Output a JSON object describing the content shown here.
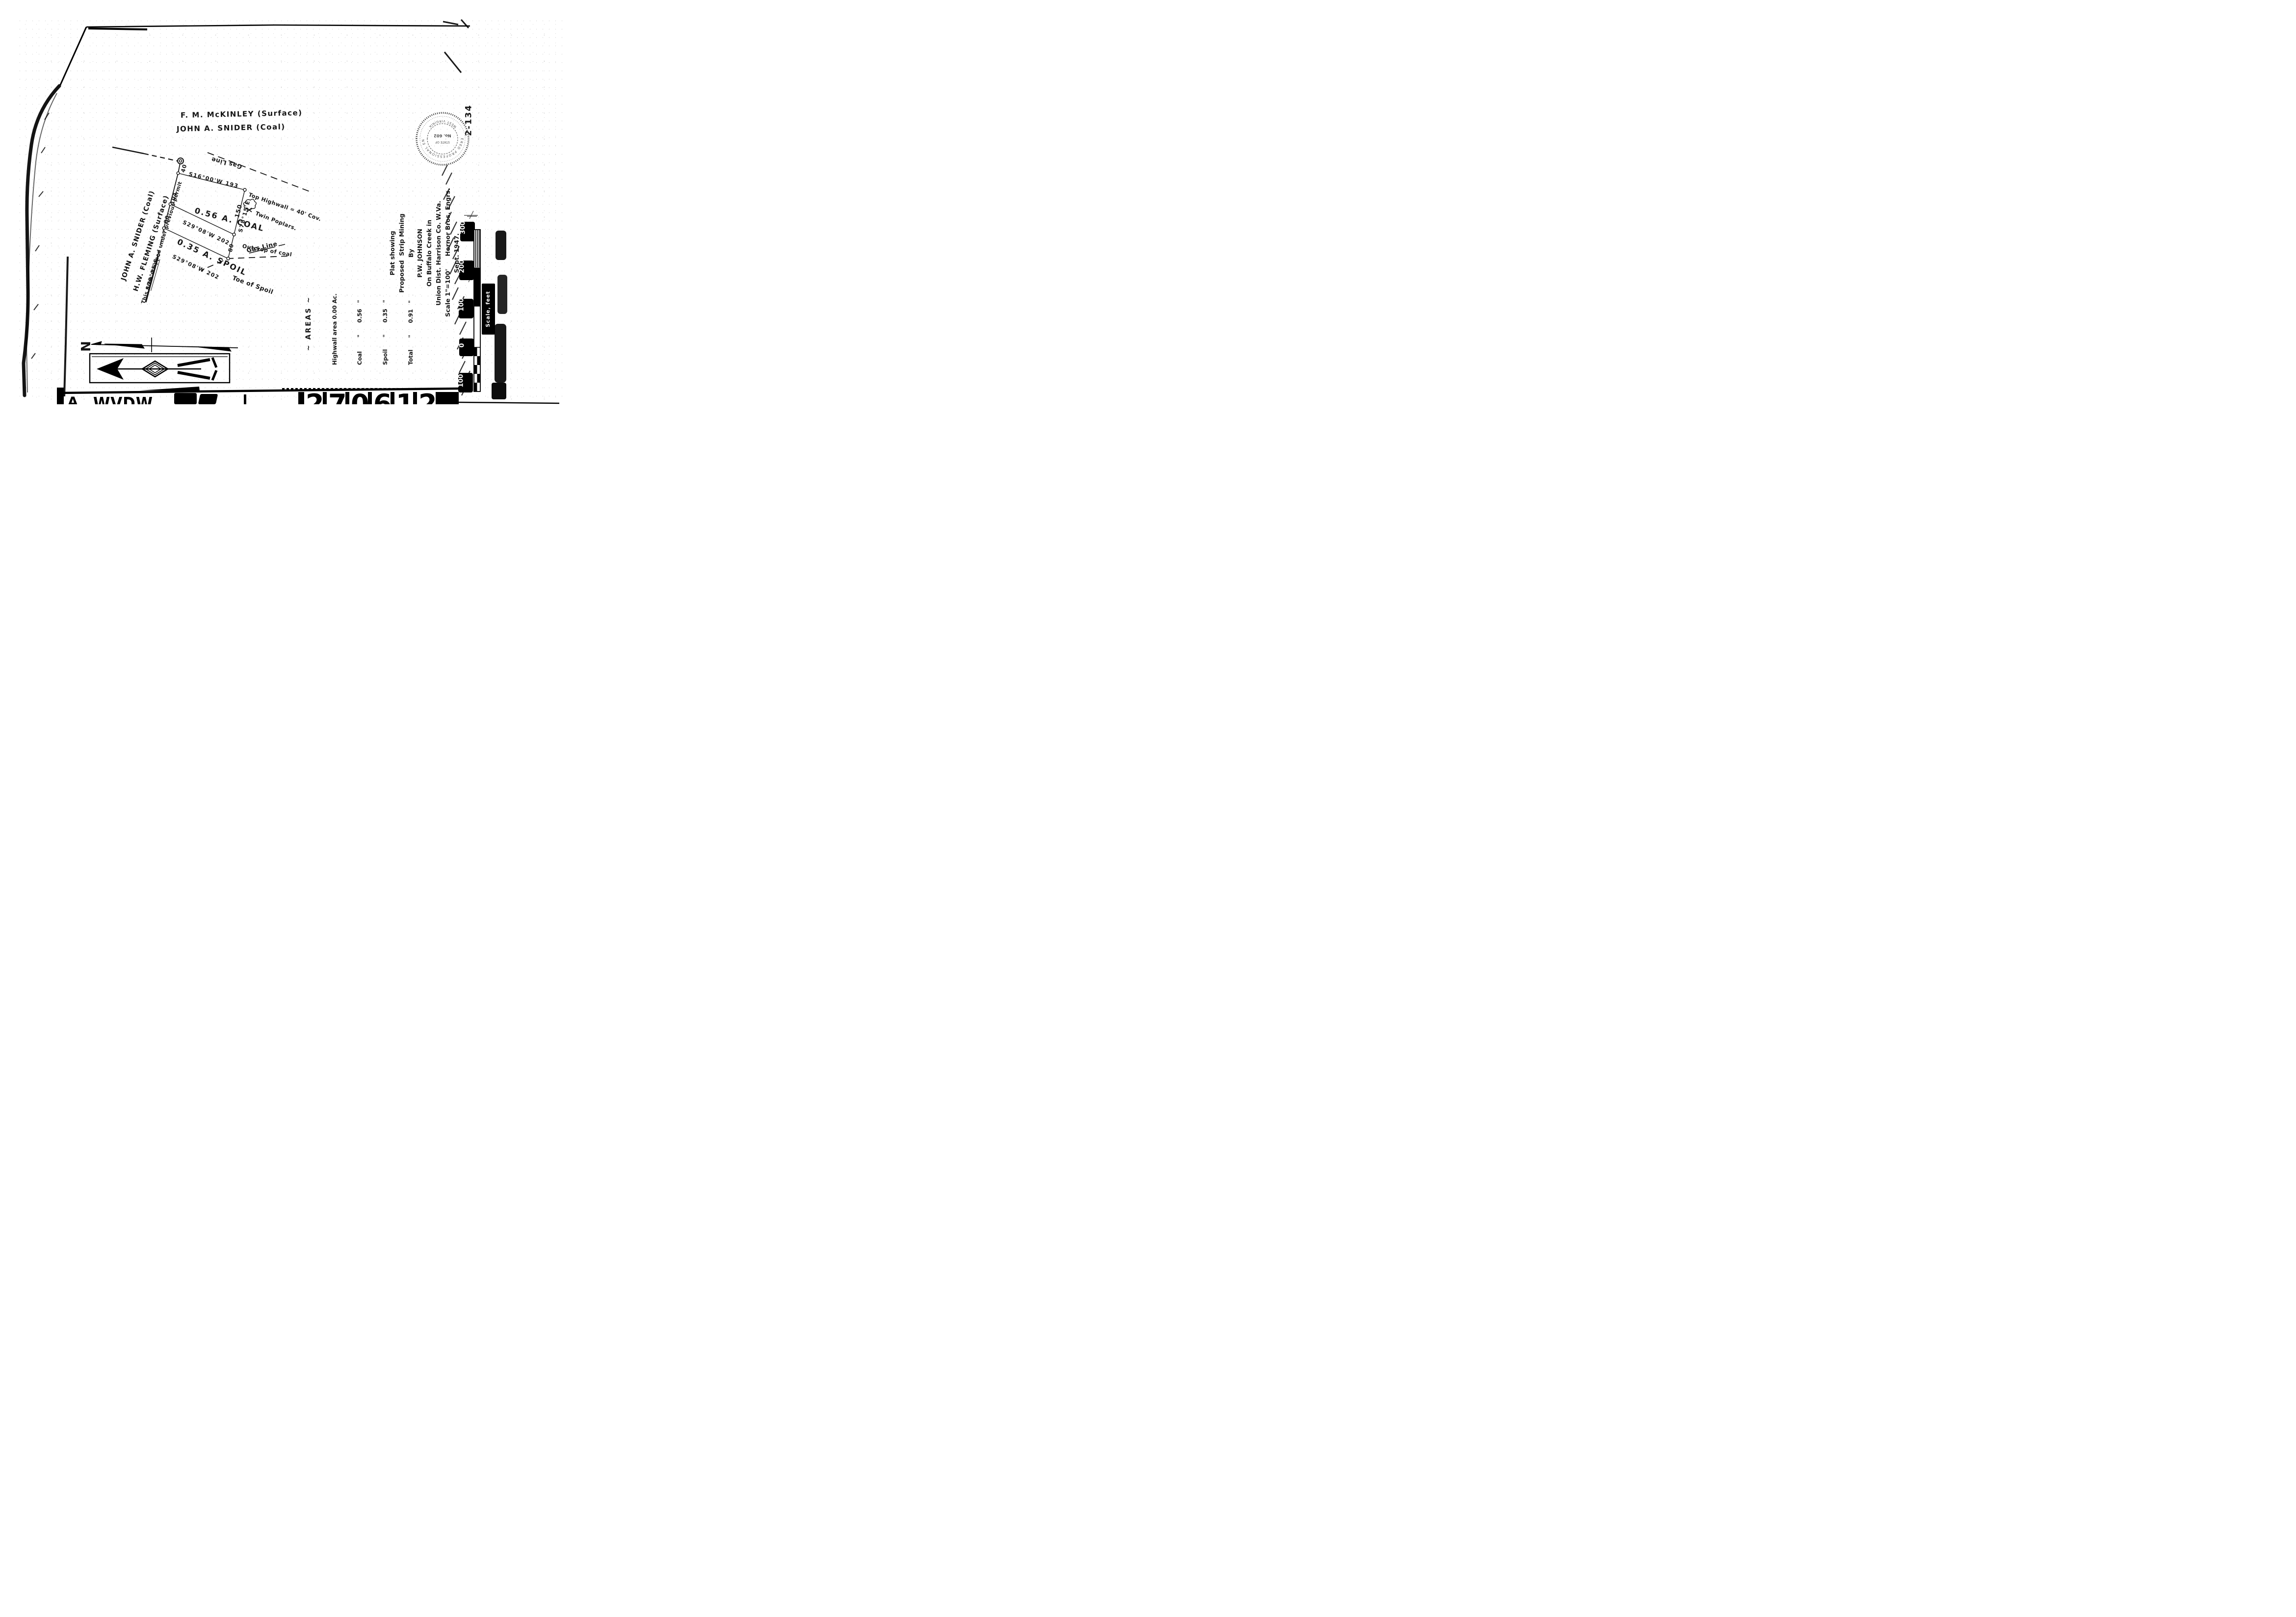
{
  "document": {
    "surface_owner_top": "F. M. McKINLEY   (Surface)",
    "coal_owner_top": "JOHN A. SNIDER   (Coal)",
    "archive_number": "2-134"
  },
  "plat": {
    "courses": {
      "s16": "S16°00'W    193",
      "s29_upper": "S29°08'W    202",
      "s29_lower": "S29°08'W    202"
    },
    "segment_lengths": {
      "left": [
        "40",
        "104",
        "80"
      ],
      "right": [
        "150",
        "80"
      ]
    },
    "bearing_right_line": "S78°15'E",
    "bearing_lower_left": "S78°15'E",
    "parcels": {
      "coal": "0.56 A.  COAL",
      "spoil": "0.35 A.  SPOIL"
    },
    "feature_labels": {
      "top_highwall": "Top Highwall = 40' Cov.",
      "twin_poplars": "Twin Poplars.",
      "outcrop": "Outcrop of coal",
      "gas_line_upper": "Gas Line",
      "gas_line_lower": "Gas Line",
      "toe_of_spoil": "Toe of Spoil"
    },
    "adjoiners": {
      "snider": "JOHN A. SNIDER (Coal)",
      "fleming": "H.W. FLEMING (Surface)",
      "stripped_note": "This area stripped under previous permit"
    }
  },
  "areas_table": {
    "heading": "~ AREAS ~",
    "row_highwall": "Highwall area 0.00 Ac.",
    "row_coal": "Coal       \"      0.56   \"",
    "row_spoil": "Spoil      \"      0.35   \"",
    "row_total": "Total      \"      0.91   \""
  },
  "title_block": {
    "line1": "Plat showing",
    "line2": "Proposed  Strip Mining",
    "line3": "By",
    "line4": "P.W. JOHNSON",
    "line5": "On Buffalo Creek in",
    "line6": "Union Dist. Harrison Co. W.Va.",
    "line7": "Scale 1\"=100'      Hornor Bros. Engrs.",
    "line8": "Sept. 1947."
  },
  "seal": {
    "ring_text_top": "REGISTERED PROFESSIONAL ENGINEER",
    "ring_text_bottom": "WEST VIRGINIA",
    "center_line1": "STATE OF",
    "center_line2": "No. 602"
  },
  "north_arrow": {
    "letter": "N"
  },
  "scale_bar": {
    "labels": [
      "300",
      "200",
      "100",
      "0",
      "100"
    ],
    "caption": "Scale, feet"
  },
  "bottom_strip": {
    "left_letter": "A",
    "agency": "WVDW",
    "digits": [
      "2",
      "7",
      "0",
      "6",
      "1",
      "2"
    ],
    "suffix_mark": "∫"
  },
  "colors": {
    "ink": "#151515",
    "paper": "#ffffff",
    "edge_black": "#000000"
  }
}
